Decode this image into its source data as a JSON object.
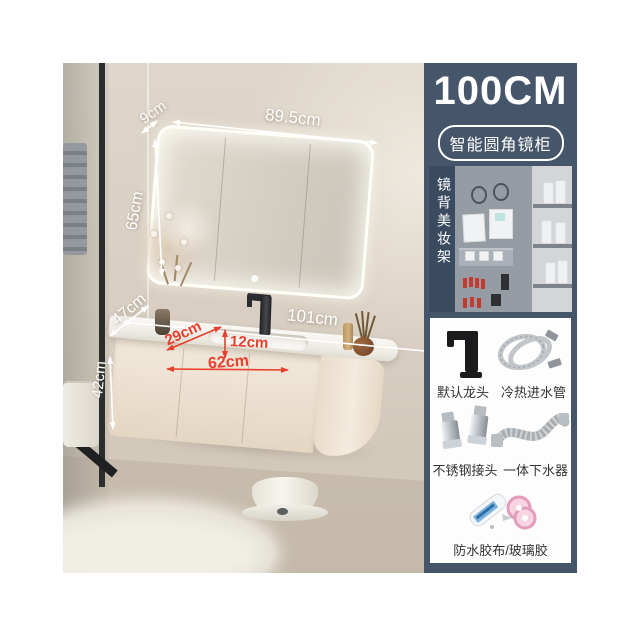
{
  "product_panel": {
    "size_label": "100CM",
    "feature_badge": "智能圆角镜柜",
    "mirror_back_label": "镜背美妆架",
    "accessories": [
      {
        "icon": "faucet-image",
        "label": "默认龙头"
      },
      {
        "icon": "hoses-image",
        "label": "冷热进水管"
      },
      {
        "icon": "connectors-image",
        "label": "不锈钢接头"
      },
      {
        "icon": "drain-image",
        "label": "一体下水器"
      },
      {
        "icon": "sealant-image",
        "label": "防水胶布/玻璃胶"
      }
    ]
  },
  "dimensions": {
    "mirror_depth": "9cm",
    "mirror_width": "89.5cm",
    "mirror_height": "65cm",
    "counter_depth": "47cm",
    "counter_width": "101cm",
    "basin_slant_width": "29cm",
    "basin_depth": "12cm",
    "basin_front_width": "62cm",
    "cabinet_height": "42cm"
  },
  "colors": {
    "panel_bg": "#46566a",
    "dimension_red": "#e8402f",
    "dimension_white": "#ffffff",
    "wall_beige": "#d7cec1",
    "cabinet_beige": "#ecdfce"
  }
}
